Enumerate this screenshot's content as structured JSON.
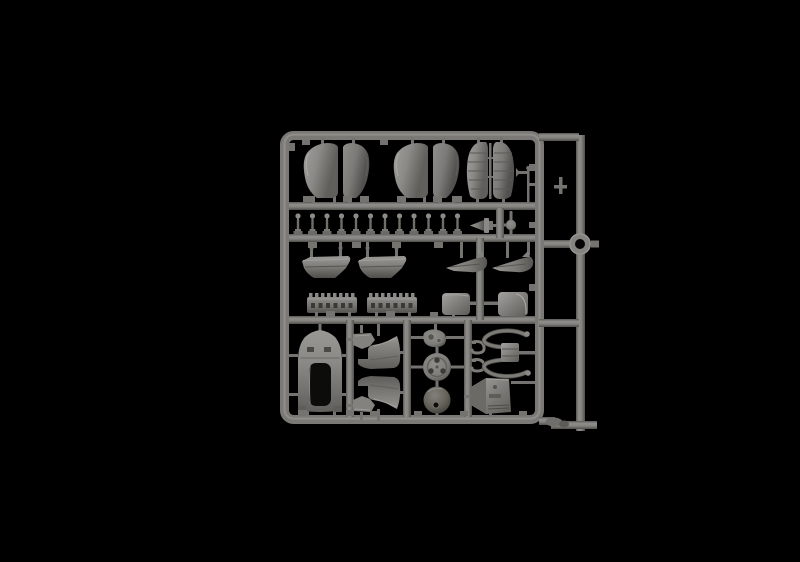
{
  "scene": {
    "description": "Studio photograph of a grey injection-moulded plastic model-kit parts sprue (runner frame) centered on a black background",
    "colors": {
      "background": "#000000",
      "plastic_base": "#7b7976",
      "plastic_light": "#a09e9a",
      "plastic_mid": "#747370",
      "plastic_dark": "#53524e",
      "plastic_deep": "#3a3936",
      "hole_dark": "#0c0c0b"
    },
    "sprue": {
      "material": "grey polystyrene",
      "approx_bounds_px": {
        "left": 238,
        "top": 113,
        "right": 560,
        "bottom": 416
      },
      "parts": [
        {
          "name": "cowling-panel-half",
          "label": "curved teardrop cowling/fairing panel halves",
          "count": 4
        },
        {
          "name": "louvered-panel-half",
          "label": "louvered cowling panel halves with rib detail",
          "count": 2
        },
        {
          "name": "antenna-mast",
          "label": "thin antenna/mast rod with T-arm",
          "count": 1
        },
        {
          "name": "pushrod-pin",
          "label": "small ball-headed pushrod pins in a row",
          "count": 12
        },
        {
          "name": "spinner-hub",
          "label": "small horizontal hub/spinner cone",
          "count": 1
        },
        {
          "name": "ball-part",
          "label": "small spherical part",
          "count": 1
        },
        {
          "name": "fairing-shell",
          "label": "trapezoidal fairing shells",
          "count": 2
        },
        {
          "name": "wheel-spat-half",
          "label": "pointed wheel-spat/drop-fairing halves with fin",
          "count": 2
        },
        {
          "name": "manifold-strip",
          "label": "long slotted manifold strips with teeth",
          "count": 2
        },
        {
          "name": "intake-box",
          "label": "rounded intake/headrest boxes",
          "count": 2
        },
        {
          "name": "engine-cowling",
          "label": "large arched engine cowling with rectangular cutout",
          "count": 1
        },
        {
          "name": "mounting-bracket",
          "label": "small angular mounting brackets (mirrored pair)",
          "count": 2
        },
        {
          "name": "fuselage-decking",
          "label": "fuselage decking fairings (mirrored pair)",
          "count": 2
        },
        {
          "name": "gear-cover",
          "label": "teardrop gear cover with twin bosses",
          "count": 1
        },
        {
          "name": "wheel-hub-disc",
          "label": "disc with three lightening holes",
          "count": 1
        },
        {
          "name": "spinner-dome",
          "label": "dome with central shaft hole",
          "count": 1
        },
        {
          "name": "hook-lever",
          "label": "small J-hook levers",
          "count": 2
        },
        {
          "name": "engine-mount-frame",
          "label": "curved tubular engine-mount frame with center block",
          "count": 1
        },
        {
          "name": "radiator-housing",
          "label": "angled radiator/oil-cooler housing",
          "count": 1
        },
        {
          "name": "cowl-ring",
          "label": "circular ring moulded on the outer runner",
          "count": 1
        }
      ]
    }
  }
}
